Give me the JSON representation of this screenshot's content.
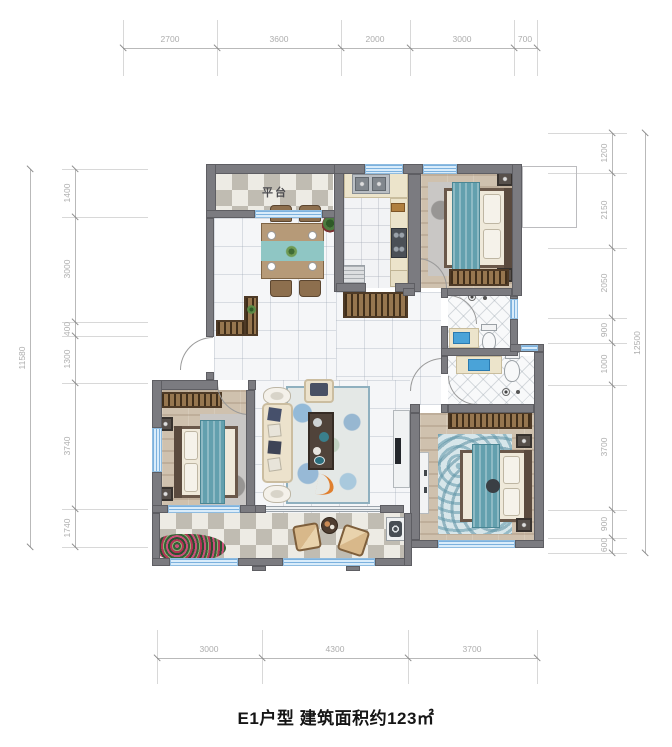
{
  "title": "E1户型 建筑面积约123㎡",
  "labels": {
    "platform": "平台"
  },
  "dimensions": {
    "top": [
      "2700",
      "3600",
      "2000",
      "3000",
      "700"
    ],
    "bottom": [
      "3000",
      "4300",
      "3700"
    ],
    "left": [
      "1400",
      "3000",
      "400",
      "1300",
      "3740",
      "1740"
    ],
    "left_total": "11580",
    "right": [
      "1200",
      "2150",
      "2050",
      "900",
      "1000",
      "3700",
      "900",
      "600"
    ],
    "right_total": "12500"
  },
  "colors": {
    "wall_gray": "#7b7b80",
    "window_blue": "#d9ecfa",
    "accent_teal": "#63a0ae",
    "wood_floor": "#cfc1ae",
    "wardrobe_brown": "#96764f",
    "dim_text": "#adadad"
  }
}
